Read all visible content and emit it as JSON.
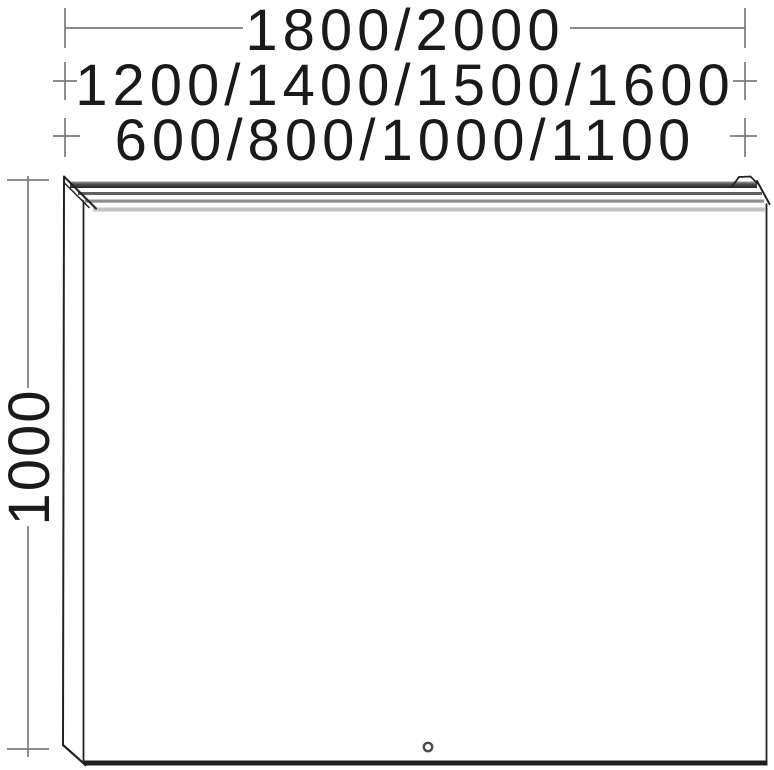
{
  "drawing": {
    "title": "mirror-with-light-dimension-drawing",
    "labels": {
      "total_width": "1800/2000",
      "mid_widths": "1200/1400/1500/1600",
      "small_widths": "600/800/1000/1100",
      "height": "1000"
    }
  },
  "colors": {
    "text": "#1a1a1a",
    "dimension_line": "#7b7b7b",
    "outline": "#222222",
    "light_band_dark": "#2b2b2b",
    "light_band_mid": "#5f5f5f",
    "light_band_soft": "#8d8d8d",
    "light_diffuser": "#c3c3c3",
    "bottom_edge": "#1f1f1f"
  }
}
